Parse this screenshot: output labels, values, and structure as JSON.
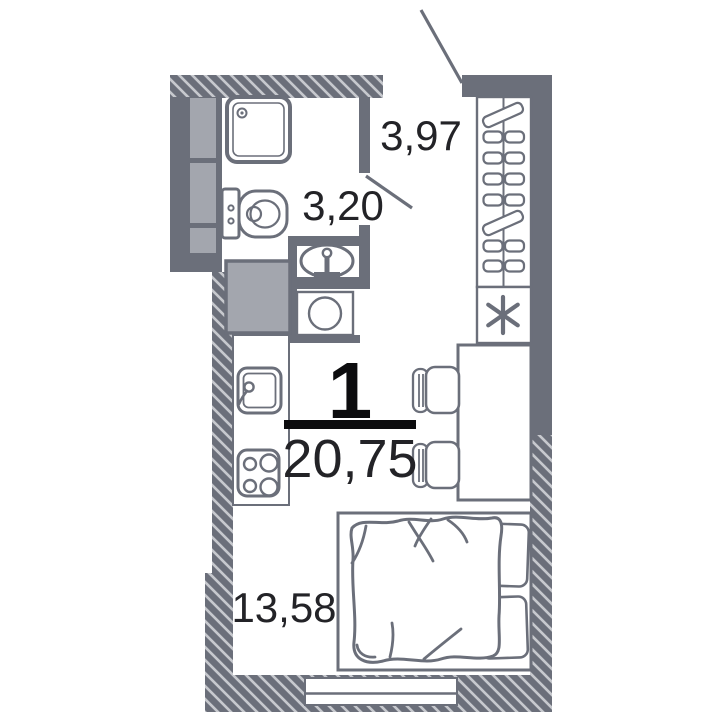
{
  "floor_plan": {
    "unit_number": "1",
    "total_area_m2": "20,75",
    "rooms": {
      "hallway": {
        "area_m2": "3,97"
      },
      "bathroom": {
        "area_m2": "3,20"
      },
      "living_kitchen": {
        "area_m2": "13,58"
      }
    },
    "fixtures": [
      "shower-tray",
      "toilet",
      "washbasin",
      "washing-machine",
      "ventilation-shafts",
      "duct-block",
      "kitchen-counter",
      "kitchen-sink",
      "hob",
      "wardrobe",
      "refrigerator",
      "dining-table",
      "chairs",
      "double-bed",
      "pillows",
      "window",
      "entrance-door",
      "bathroom-door"
    ],
    "colors": {
      "wall": "#6b6f7a",
      "shaft": "#a3a6ae",
      "hatch_line": "#c7c9ce",
      "label_text": "#232327",
      "accent": "#0c0c0e",
      "background": "#ffffff"
    }
  }
}
